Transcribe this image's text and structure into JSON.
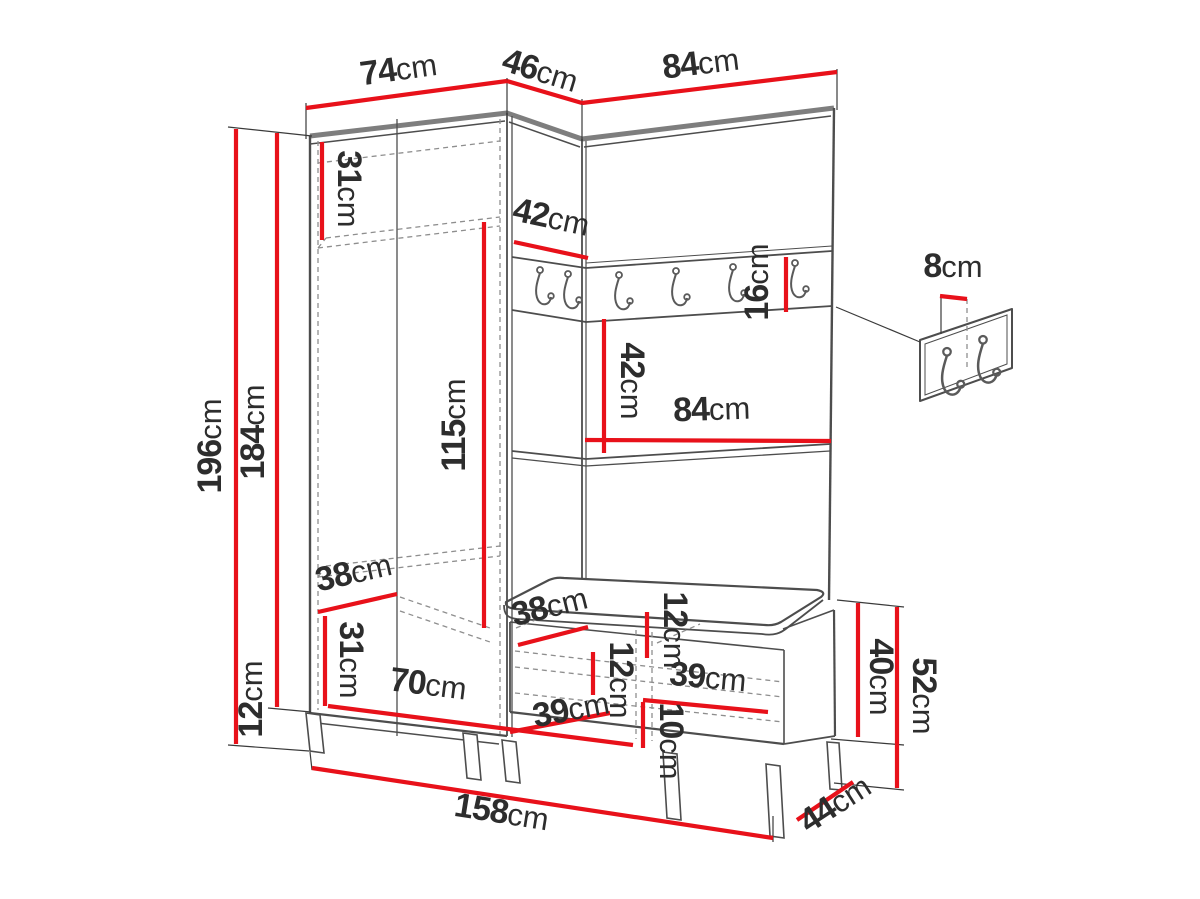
{
  "unit": "cm",
  "colors": {
    "dimension_red": "#e8111a",
    "outline_dark": "#4d4d4d",
    "outline_light": "#7e7e7e",
    "text": "#2d2d2d",
    "background": "#ffffff"
  },
  "diagram_type": "furniture-dimension-drawing",
  "dims": {
    "wardrobe_width": {
      "v": "74",
      "u": "cm"
    },
    "corner_width": {
      "v": "46",
      "u": "cm"
    },
    "panel_width": {
      "v": "84",
      "u": "cm"
    },
    "total_height": {
      "v": "196",
      "u": "cm"
    },
    "cabinet_height": {
      "v": "184",
      "u": "cm"
    },
    "leg_height": {
      "v": "12",
      "u": "cm"
    },
    "top_shelf_height": {
      "v": "31",
      "u": "cm"
    },
    "corner_shelf_depth": {
      "v": "42",
      "u": "cm"
    },
    "hanging_height": {
      "v": "115",
      "u": "cm"
    },
    "panel_shelf_drop": {
      "v": "42",
      "u": "cm"
    },
    "shelf_width": {
      "v": "84",
      "u": "cm"
    },
    "rail_height": {
      "v": "16",
      "u": "cm"
    },
    "hook_offset": {
      "v": "8",
      "u": "cm"
    },
    "wardrobe_inner_depth": {
      "v": "38",
      "u": "cm"
    },
    "bottom_section_height": {
      "v": "31",
      "u": "cm"
    },
    "wardrobe_inner_width": {
      "v": "70",
      "u": "cm"
    },
    "bench_inner_depth": {
      "v": "38",
      "u": "cm"
    },
    "cushion_height": {
      "v": "12",
      "u": "cm"
    },
    "bench_inner_height": {
      "v": "12",
      "u": "cm"
    },
    "bench_comp_left": {
      "v": "39",
      "u": "cm"
    },
    "bench_comp_right": {
      "v": "39",
      "u": "cm"
    },
    "bench_plinth": {
      "v": "10",
      "u": "cm"
    },
    "bench_box_height": {
      "v": "40",
      "u": "cm"
    },
    "bench_total_height": {
      "v": "52",
      "u": "cm"
    },
    "bench_depth": {
      "v": "44",
      "u": "cm"
    },
    "total_width": {
      "v": "158",
      "u": "cm"
    }
  }
}
